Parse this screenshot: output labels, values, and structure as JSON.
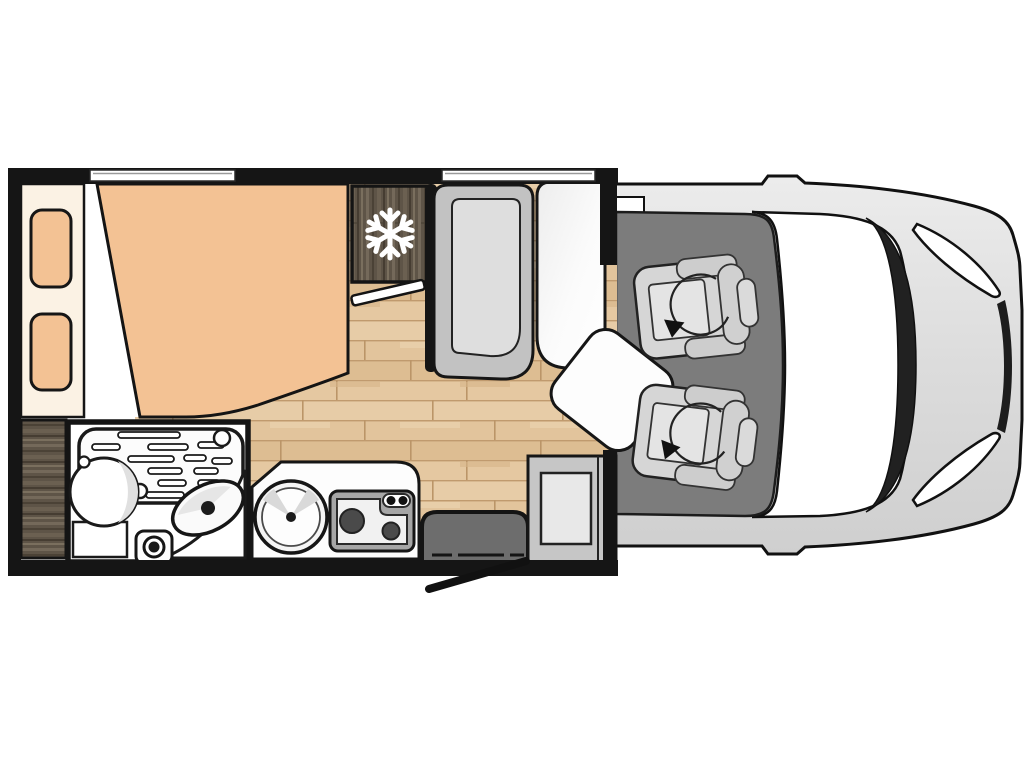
{
  "page": {
    "background": "#ffffff",
    "kind": "motorhome-floorplan-top-view"
  },
  "palette": {
    "page_bg": "#ffffff",
    "wall": "#151515",
    "bed_peach": "#f3c294",
    "cream": "#fbf2e4",
    "dark_wood": "#5e5447",
    "dark_wood_hi": "#74695a",
    "dark_wood_lo": "#463d32",
    "floor_wood": "#e2c49c",
    "floor_wood_line": "#c09a6e",
    "floor_wood_hi": "#ecd5b2",
    "cab_floor": "#7c7c7c",
    "vehicle_body": "#dcdcdc",
    "vehicle_body_hi": "#ebebeb",
    "glass_frame": "#212121",
    "seat_gray": "#d6d6d6",
    "seat_cushion": "#e4e4e4",
    "bench_gray": "#c2c2c2",
    "bench_cushion": "#dedede",
    "fixture_white": "#fdfdfd",
    "fixture_shade": "#e0e0e0",
    "step_gray": "#6d6d6d",
    "cabinet_gray": "#c6c6c6",
    "cabinet_panel": "#e8e8e8",
    "hob_gray": "#a6a6a6",
    "hob_panel": "#f1f1f1",
    "burner_dark": "#4a4a4a",
    "snowflake": "#ffffff",
    "outline": "#111111"
  },
  "components": {
    "bedroom": {
      "bed": "double-bed",
      "pillow_count": 2,
      "headboard": "headboard-shelf",
      "wardrobe": "wardrobe"
    },
    "cooling": {
      "fridge": "refrigerator-cabinet",
      "icon": "snowflake-icon"
    },
    "bathroom": {
      "shower": "shower-tray",
      "toilet": "toilet",
      "basin": "washbasin",
      "drain": "shower-drain"
    },
    "kitchen": {
      "sink": "round-sink",
      "hob": "two-burner-hob",
      "burner_count": 2,
      "knob_count": 2
    },
    "lounge": {
      "bench": "travel-bench-seat",
      "table": "dinette-table",
      "extension": "swivel-table-extension"
    },
    "entrance": {
      "step": "entry-step",
      "door": "entry-door-open",
      "cabinet": "side-cabinet"
    },
    "cab": {
      "seat_count": 2,
      "seats": [
        "passenger-swivel-seat",
        "driver-swivel-seat"
      ],
      "swivel_icon": "rotation-arrow-icon",
      "windshield": "windshield",
      "headlight_count": 2
    },
    "window_count": 2
  }
}
